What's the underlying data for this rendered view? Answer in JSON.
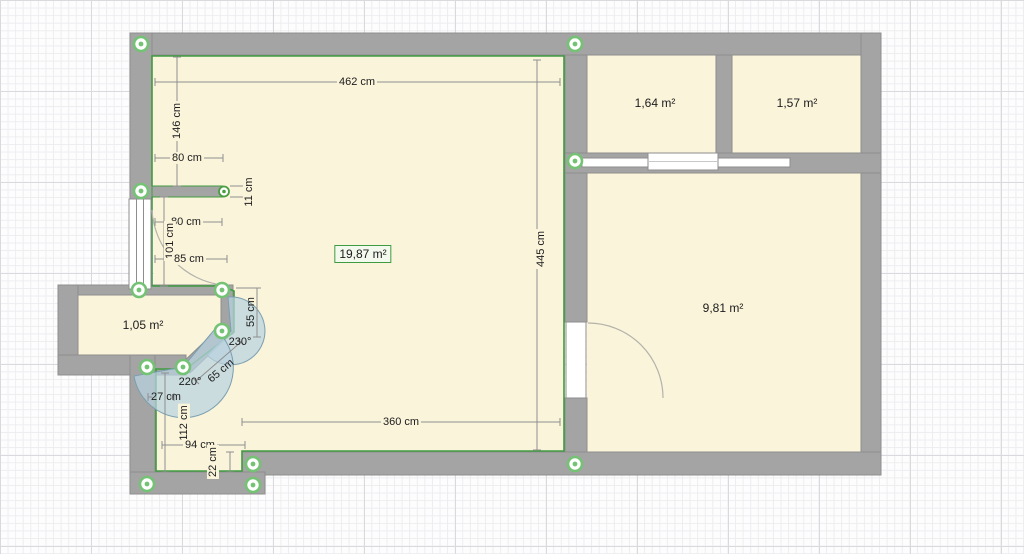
{
  "canvas": {
    "width": 1024,
    "height": 554,
    "tool": "floor-plan-editor"
  },
  "rooms": [
    {
      "name": "living-room",
      "area_label": "19,87 m²",
      "selected": true
    },
    {
      "name": "closet-left",
      "area_label": "1,64 m²",
      "selected": false
    },
    {
      "name": "closet-right",
      "area_label": "1,57 m²",
      "selected": false
    },
    {
      "name": "bedroom",
      "area_label": "9,81 m²",
      "selected": false
    },
    {
      "name": "niche",
      "area_label": "1,05 m²",
      "selected": false
    }
  ],
  "dimensions": [
    {
      "label": "462 cm",
      "orientation": "horizontal"
    },
    {
      "label": "146 cm",
      "orientation": "vertical"
    },
    {
      "label": "80 cm",
      "orientation": "horizontal"
    },
    {
      "label": "11 cm",
      "orientation": "vertical"
    },
    {
      "label": "80 cm",
      "orientation": "horizontal"
    },
    {
      "label": "101 cm",
      "orientation": "vertical"
    },
    {
      "label": "85 cm",
      "orientation": "horizontal"
    },
    {
      "label": "55 cm",
      "orientation": "vertical"
    },
    {
      "label": "65 cm",
      "orientation": "diagonal"
    },
    {
      "label": "27 cm",
      "orientation": "horizontal"
    },
    {
      "label": "112 cm",
      "orientation": "vertical"
    },
    {
      "label": "94 cm",
      "orientation": "horizontal"
    },
    {
      "label": "22 cm",
      "orientation": "vertical"
    },
    {
      "label": "360 cm",
      "orientation": "horizontal"
    },
    {
      "label": "445 cm",
      "orientation": "vertical"
    }
  ],
  "door_angles": [
    {
      "label": "230°"
    },
    {
      "label": "220°"
    }
  ],
  "colors": {
    "wall": "#a4a4a4",
    "wall_outline": "#8e8e8e",
    "floor": "#faf4db",
    "selection_green": "#3f9b41",
    "marker_green": "#74c274",
    "door_swing_fill": "#b9d2df",
    "door_swing_stroke": "#7b9fb0",
    "grid_minor": "#ededf0",
    "grid_major": "#d9d9de",
    "dimension_line": "#8f8f8f",
    "text": "#1c1c1c"
  }
}
